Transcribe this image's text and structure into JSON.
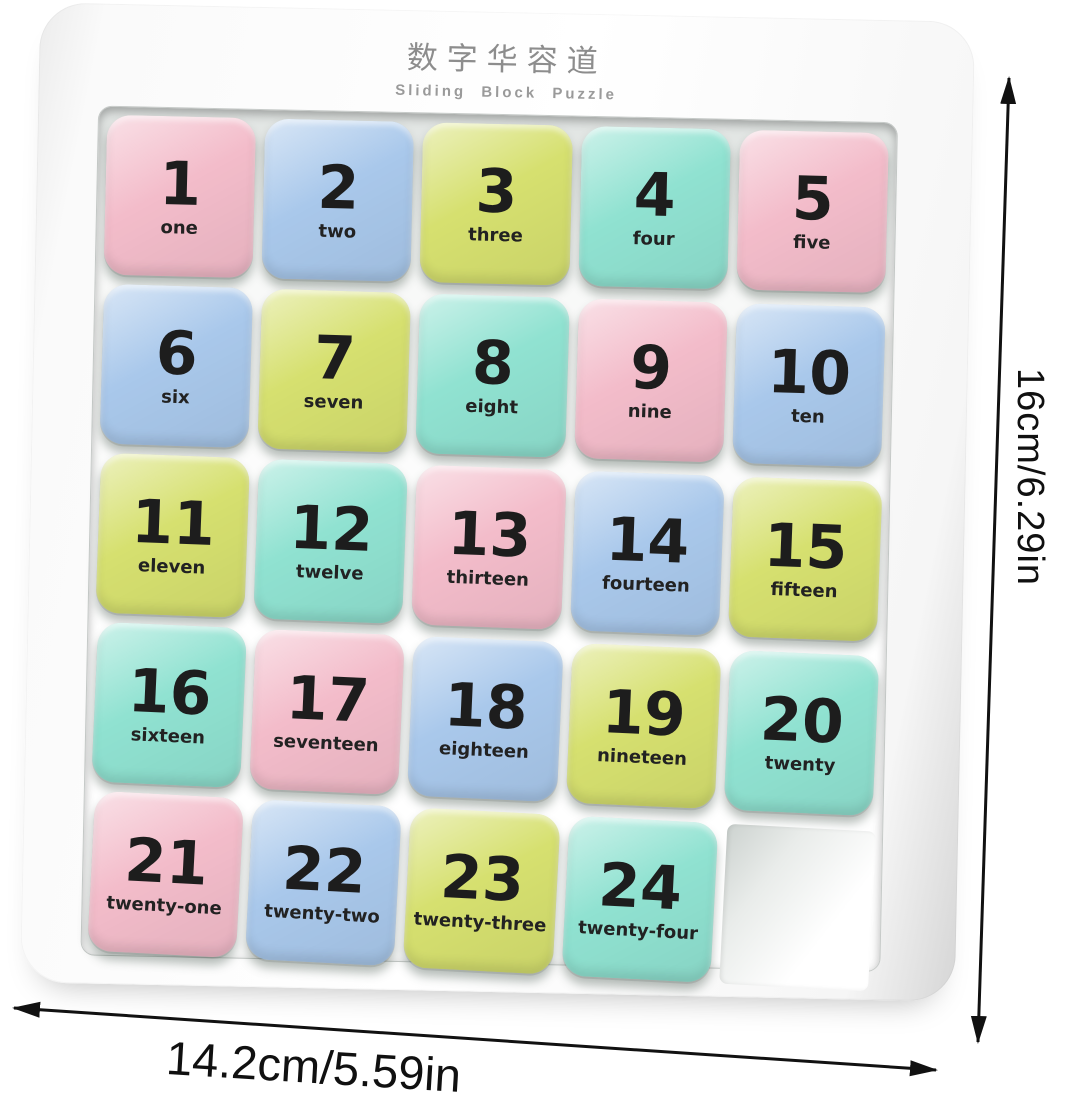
{
  "header": {
    "title_zh": "数字华容道",
    "title_en": "Sliding Block Puzzle"
  },
  "board": {
    "grid": "5x5",
    "empty_slot": {
      "row": 5,
      "col": 5
    },
    "rows": [
      {
        "cells": [
          {
            "number": "1",
            "word": "one",
            "color": "pink"
          },
          {
            "number": "2",
            "word": "two",
            "color": "blue"
          },
          {
            "number": "3",
            "word": "three",
            "color": "lime"
          },
          {
            "number": "4",
            "word": "four",
            "color": "mint"
          },
          {
            "number": "5",
            "word": "five",
            "color": "pink"
          }
        ]
      },
      {
        "cells": [
          {
            "number": "6",
            "word": "six",
            "color": "blue"
          },
          {
            "number": "7",
            "word": "seven",
            "color": "lime"
          },
          {
            "number": "8",
            "word": "eight",
            "color": "mint"
          },
          {
            "number": "9",
            "word": "nine",
            "color": "pink"
          },
          {
            "number": "10",
            "word": "ten",
            "color": "blue"
          }
        ]
      },
      {
        "cells": [
          {
            "number": "11",
            "word": "eleven",
            "color": "lime"
          },
          {
            "number": "12",
            "word": "twelve",
            "color": "mint"
          },
          {
            "number": "13",
            "word": "thirteen",
            "color": "pink"
          },
          {
            "number": "14",
            "word": "fourteen",
            "color": "blue"
          },
          {
            "number": "15",
            "word": "fifteen",
            "color": "lime"
          }
        ]
      },
      {
        "cells": [
          {
            "number": "16",
            "word": "sixteen",
            "color": "mint"
          },
          {
            "number": "17",
            "word": "seventeen",
            "color": "pink"
          },
          {
            "number": "18",
            "word": "eighteen",
            "color": "blue"
          },
          {
            "number": "19",
            "word": "nineteen",
            "color": "lime"
          },
          {
            "number": "20",
            "word": "twenty",
            "color": "mint"
          }
        ]
      },
      {
        "cells": [
          {
            "number": "21",
            "word": "twenty-one",
            "color": "pink"
          },
          {
            "number": "22",
            "word": "twenty-two",
            "color": "blue"
          },
          {
            "number": "23",
            "word": "twenty-three",
            "color": "lime"
          },
          {
            "number": "24",
            "word": "twenty-four",
            "color": "mint"
          },
          {
            "empty": true
          }
        ]
      }
    ]
  },
  "colors": {
    "pink": "#f3bcca",
    "blue": "#a9c8eb",
    "lime": "#d6e06f",
    "mint": "#90e2d1",
    "frame": "#fbfbfb",
    "arrow": "#111111"
  },
  "dimensions": {
    "height_label": "16cm/6.29in",
    "width_label": "14.2cm/5.59in"
  },
  "icons": {
    "height_arrow": "double-arrow-vertical",
    "width_arrow": "double-arrow-horizontal"
  }
}
